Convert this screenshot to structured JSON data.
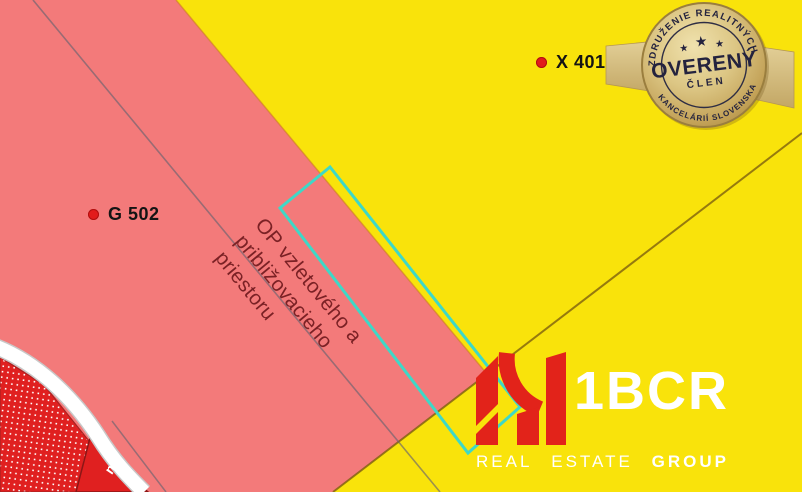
{
  "map": {
    "labels": {
      "parcel_g": "G 502",
      "parcel_x": "X 401",
      "road_fragment": "m"
    },
    "zone_note": {
      "line1": "OP vzletového a",
      "line2": "približovacieho",
      "line3": "priestoru"
    },
    "colors": {
      "yellow": "#F9E30B",
      "pink": "#F37A7A",
      "red": "#E02020",
      "cyan": "#3ED8C7",
      "grey_line": "rgba(105,100,112,0.65)",
      "boundary_brown": "rgba(125,95,15,0.8)",
      "boundary_orange": "rgba(205,125,35,0.6)",
      "note_text": "#7B2125"
    }
  },
  "badge": {
    "arc_top": "ZDRUŽENIE REALITNÝCH",
    "arc_bottom": "KANCELÁRIÍ SLOVENSKA",
    "title": "OVERENÝ",
    "subtitle": "ČLEN",
    "star": "★"
  },
  "logo": {
    "name": "1BCR",
    "tagline": [
      "REAL",
      "ESTATE",
      "GROUP"
    ],
    "brand_red": "#E2231A"
  }
}
